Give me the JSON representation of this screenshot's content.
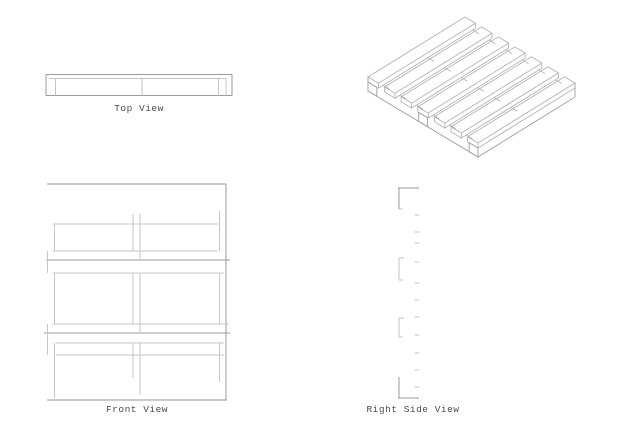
{
  "drawing": {
    "kind": "pallet-multiview-technical-drawing",
    "views": {
      "top": {
        "label": "Top View"
      },
      "front": {
        "label": "Front View"
      },
      "right_side": {
        "label": "Right Side View"
      },
      "isometric": {
        "label": ""
      }
    },
    "colors": {
      "background": "#ffffff",
      "line_light": "#c6c6c6",
      "line_mid": "#9a9a9a",
      "line_iso": "#b3b3b3",
      "label_text": "#4a4a4a"
    }
  }
}
